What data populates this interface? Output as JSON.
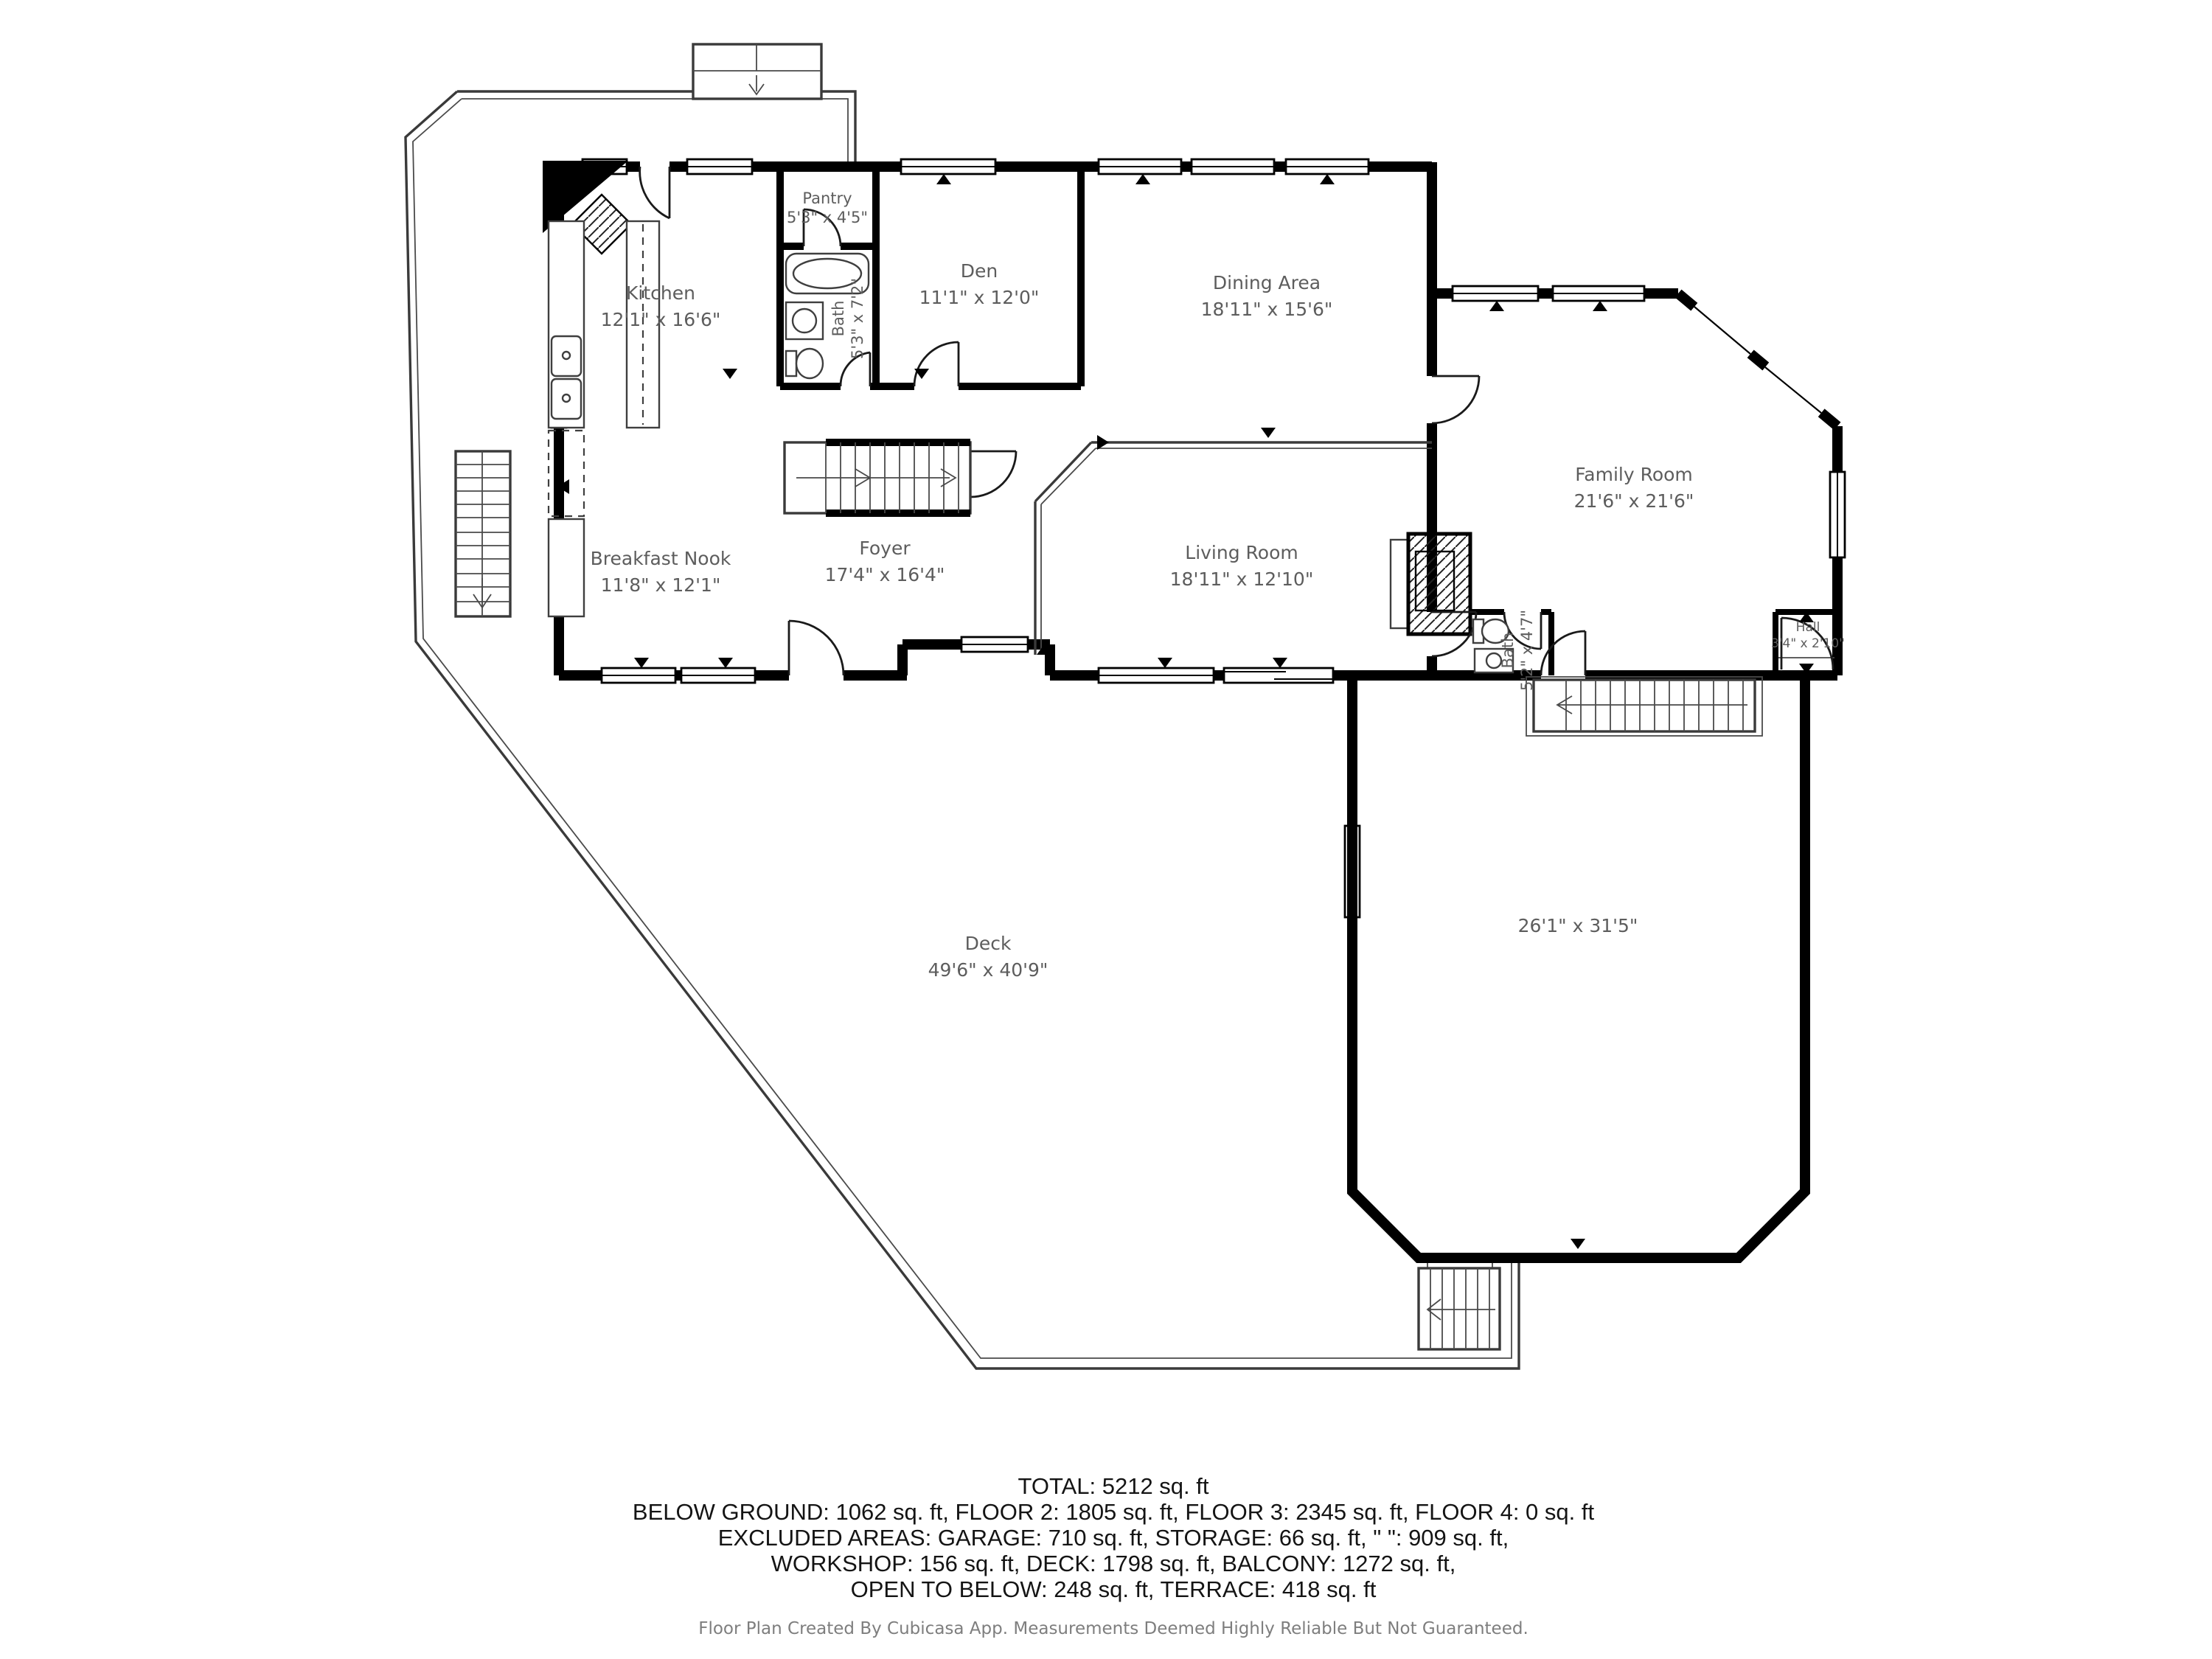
{
  "floor_plan": {
    "colors": {
      "wall": "#000000",
      "room_label": "#5d5d5d",
      "summary_text": "#141414",
      "footer_text": "#7e7e7e",
      "background": "#ffffff"
    },
    "rooms": [
      {
        "id": "kitchen",
        "name": "Kitchen",
        "dims": "12'1\" x 16'6\""
      },
      {
        "id": "pantry",
        "name": "Pantry",
        "dims": "5'3\" x 4'5\""
      },
      {
        "id": "bath-upper",
        "name": "Bath",
        "dims": "5'3\" x 7'2\""
      },
      {
        "id": "den",
        "name": "Den",
        "dims": "11'1\" x 12'0\""
      },
      {
        "id": "dining-area",
        "name": "Dining Area",
        "dims": "18'11\" x 15'6\""
      },
      {
        "id": "family-room",
        "name": "Family Room",
        "dims": "21'6\" x 21'6\""
      },
      {
        "id": "foyer",
        "name": "Foyer",
        "dims": "17'4\" x 16'4\""
      },
      {
        "id": "living-room",
        "name": "Living Room",
        "dims": "18'11\" x 12'10\""
      },
      {
        "id": "breakfast-nook",
        "name": "Breakfast Nook",
        "dims": "11'8\" x 12'1\""
      },
      {
        "id": "bath-lower",
        "name": "Bath",
        "dims": "5'2\" x 4'7\""
      },
      {
        "id": "hall",
        "name": "Hall",
        "dims": "3'4\" x 2'10\""
      },
      {
        "id": "deck",
        "name": "Deck",
        "dims": "49'6\" x 40'9\""
      },
      {
        "id": "balcony",
        "name": "",
        "dims": "26'1\" x 31'5\""
      }
    ],
    "summary": {
      "line1": "TOTAL: 5212 sq. ft",
      "line2": "BELOW GROUND: 1062 sq. ft, FLOOR 2: 1805 sq. ft, FLOOR 3: 2345 sq. ft, FLOOR 4: 0 sq. ft",
      "line3": "EXCLUDED AREAS: GARAGE: 710 sq. ft, STORAGE: 66 sq. ft, \" \": 909 sq. ft,",
      "line4": "WORKSHOP: 156 sq. ft, DECK: 1798 sq. ft, BALCONY: 1272 sq. ft,",
      "line5": "OPEN TO BELOW: 248 sq. ft, TERRACE: 418 sq. ft"
    },
    "footer": "Floor Plan Created By Cubicasa App. Measurements Deemed Highly Reliable But Not Guaranteed."
  }
}
